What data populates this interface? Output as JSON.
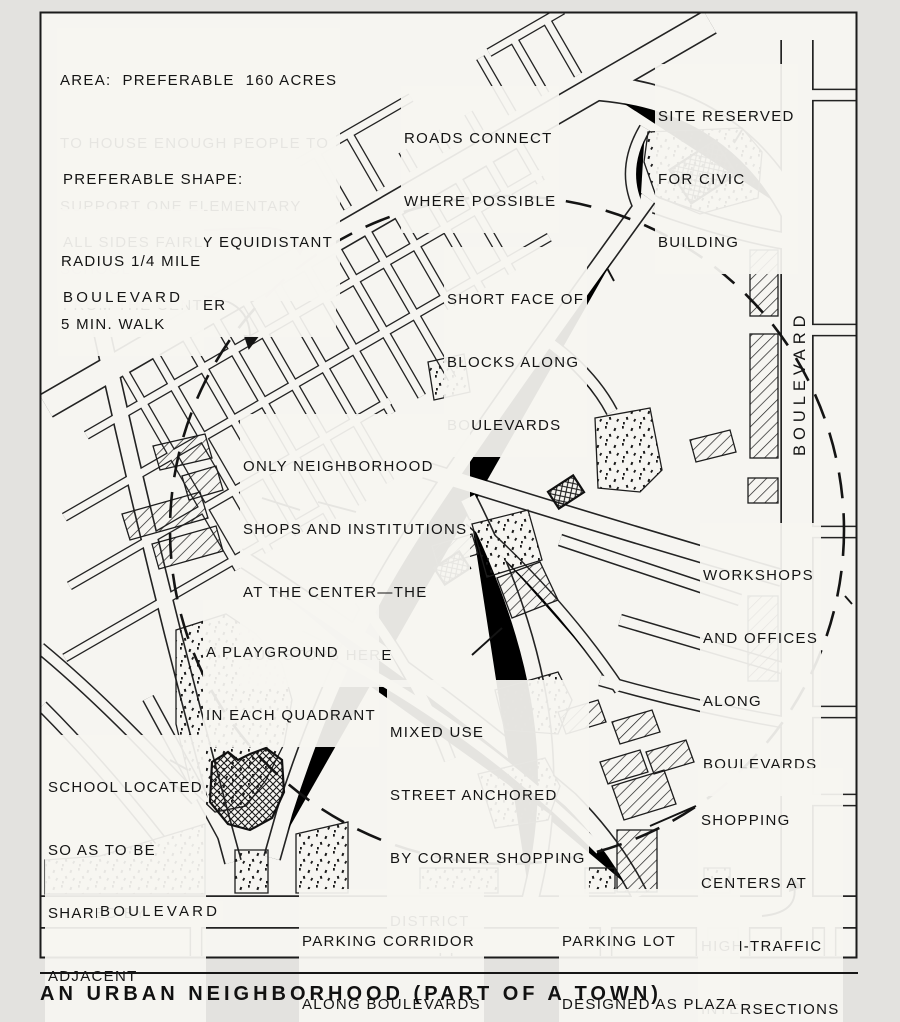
{
  "title": "AN URBAN NEIGHBORHOOD (PART OF A TOWN)",
  "notes": {
    "area": [
      "AREA:  PREFERABLE  160 ACRES",
      "TO HOUSE ENOUGH PEOPLE TO",
      "SUPPORT ONE ELEMENTARY",
      "SCHOOL"
    ],
    "shape": [
      "PREFERABLE SHAPE:",
      "ALL SIDES FAIRLY EQUIDISTANT",
      "FROM THE CENTER"
    ],
    "radius": [
      "RADIUS 1/4 MILE",
      "5 MIN. WALK"
    ]
  },
  "labels": {
    "boulevard_left": "BOULEVARD",
    "boulevard_right": "BOULEVARD",
    "boulevard_bottom": "BOULEVARD"
  },
  "callouts": {
    "roads_connect": [
      "ROADS CONNECT",
      "WHERE POSSIBLE"
    ],
    "civic_site": [
      "SITE RESERVED",
      "FOR CIVIC",
      "BUILDING"
    ],
    "short_face": [
      "SHORT FACE OF",
      "BLOCKS ALONG",
      "BOULEVARDS"
    ],
    "center": [
      "ONLY NEIGHBORHOOD",
      "SHOPS AND INSTITUTIONS",
      "AT THE CENTER—THE",
      "BUS STOPS HERE"
    ],
    "workshops": [
      "WORKSHOPS",
      "AND OFFICES",
      "ALONG",
      "BOULEVARDS"
    ],
    "playground": [
      "A PLAYGROUND",
      "IN EACH QUADRANT"
    ],
    "mixed_use": [
      "MIXED USE",
      "STREET ANCHORED",
      "BY CORNER SHOPPING",
      "DISTRICT"
    ],
    "school": [
      "SCHOOL LOCATED",
      "SO AS TO BE",
      "SHARED BY",
      "ADJACENT",
      "NEIGHBORHOOD"
    ],
    "shopping": [
      "SHOPPING",
      "CENTERS AT",
      "HIGH-TRAFFIC",
      "INTERSECTIONS"
    ],
    "parking_corridor": [
      "PARKING CORRIDOR",
      "ALONG BOULEVARDS"
    ],
    "parking_lot": [
      "PARKING LOT",
      "DESIGNED AS PLAZA"
    ]
  },
  "colors": {
    "ink": "#1c1c1c",
    "paper": "#f6f5f1",
    "page_background": "#e3e2df"
  }
}
